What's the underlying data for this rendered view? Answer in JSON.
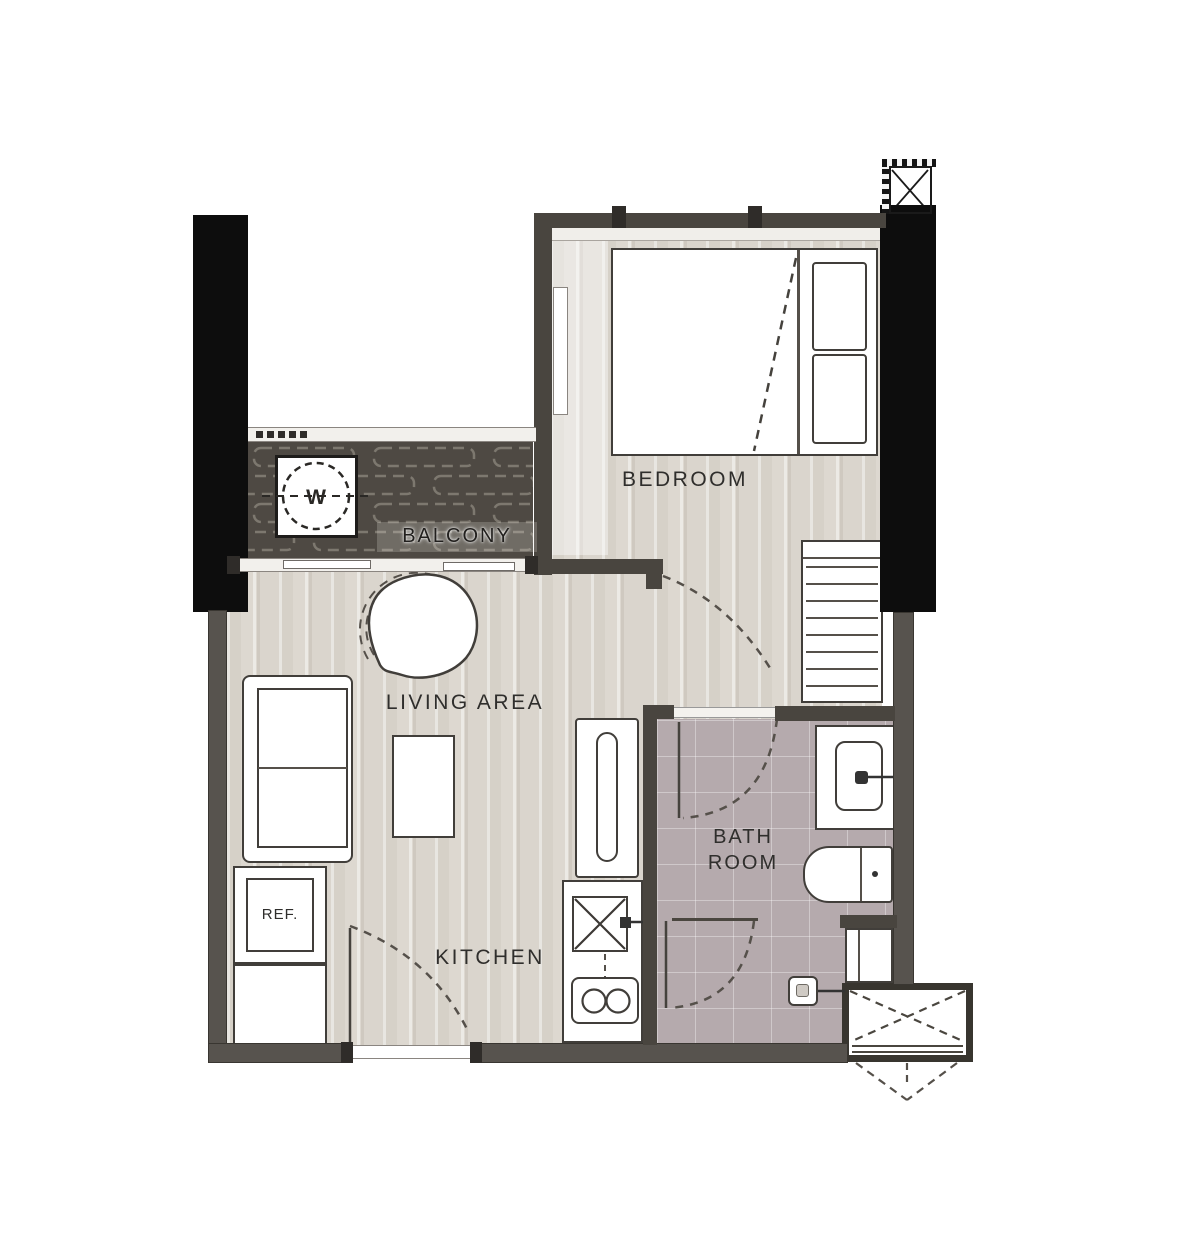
{
  "title": "One-bedroom condominium unit floor plan",
  "rooms": {
    "bedroom": {
      "label": "BEDROOM"
    },
    "balcony": {
      "label": "BALCONY"
    },
    "living": {
      "label": "LIVING AREA"
    },
    "kitchen": {
      "label": "KITCHEN"
    },
    "bathroom": {
      "label_line1": "BATH",
      "label_line2": "ROOM"
    }
  },
  "fixtures": {
    "refrigerator": {
      "label": "REF."
    },
    "washing_machine": {
      "label": "W"
    }
  },
  "colors": {
    "column": "#0d0d0d",
    "exterior_wall": "#57534e",
    "partition_wall": "#49453f",
    "wood_floor": "#d8d3ca",
    "balcony_floor": "#4e4943",
    "bathroom_floor": "#b5aaad",
    "fixture_outline": "#413e3a",
    "label_text": "#2f2e2c"
  }
}
